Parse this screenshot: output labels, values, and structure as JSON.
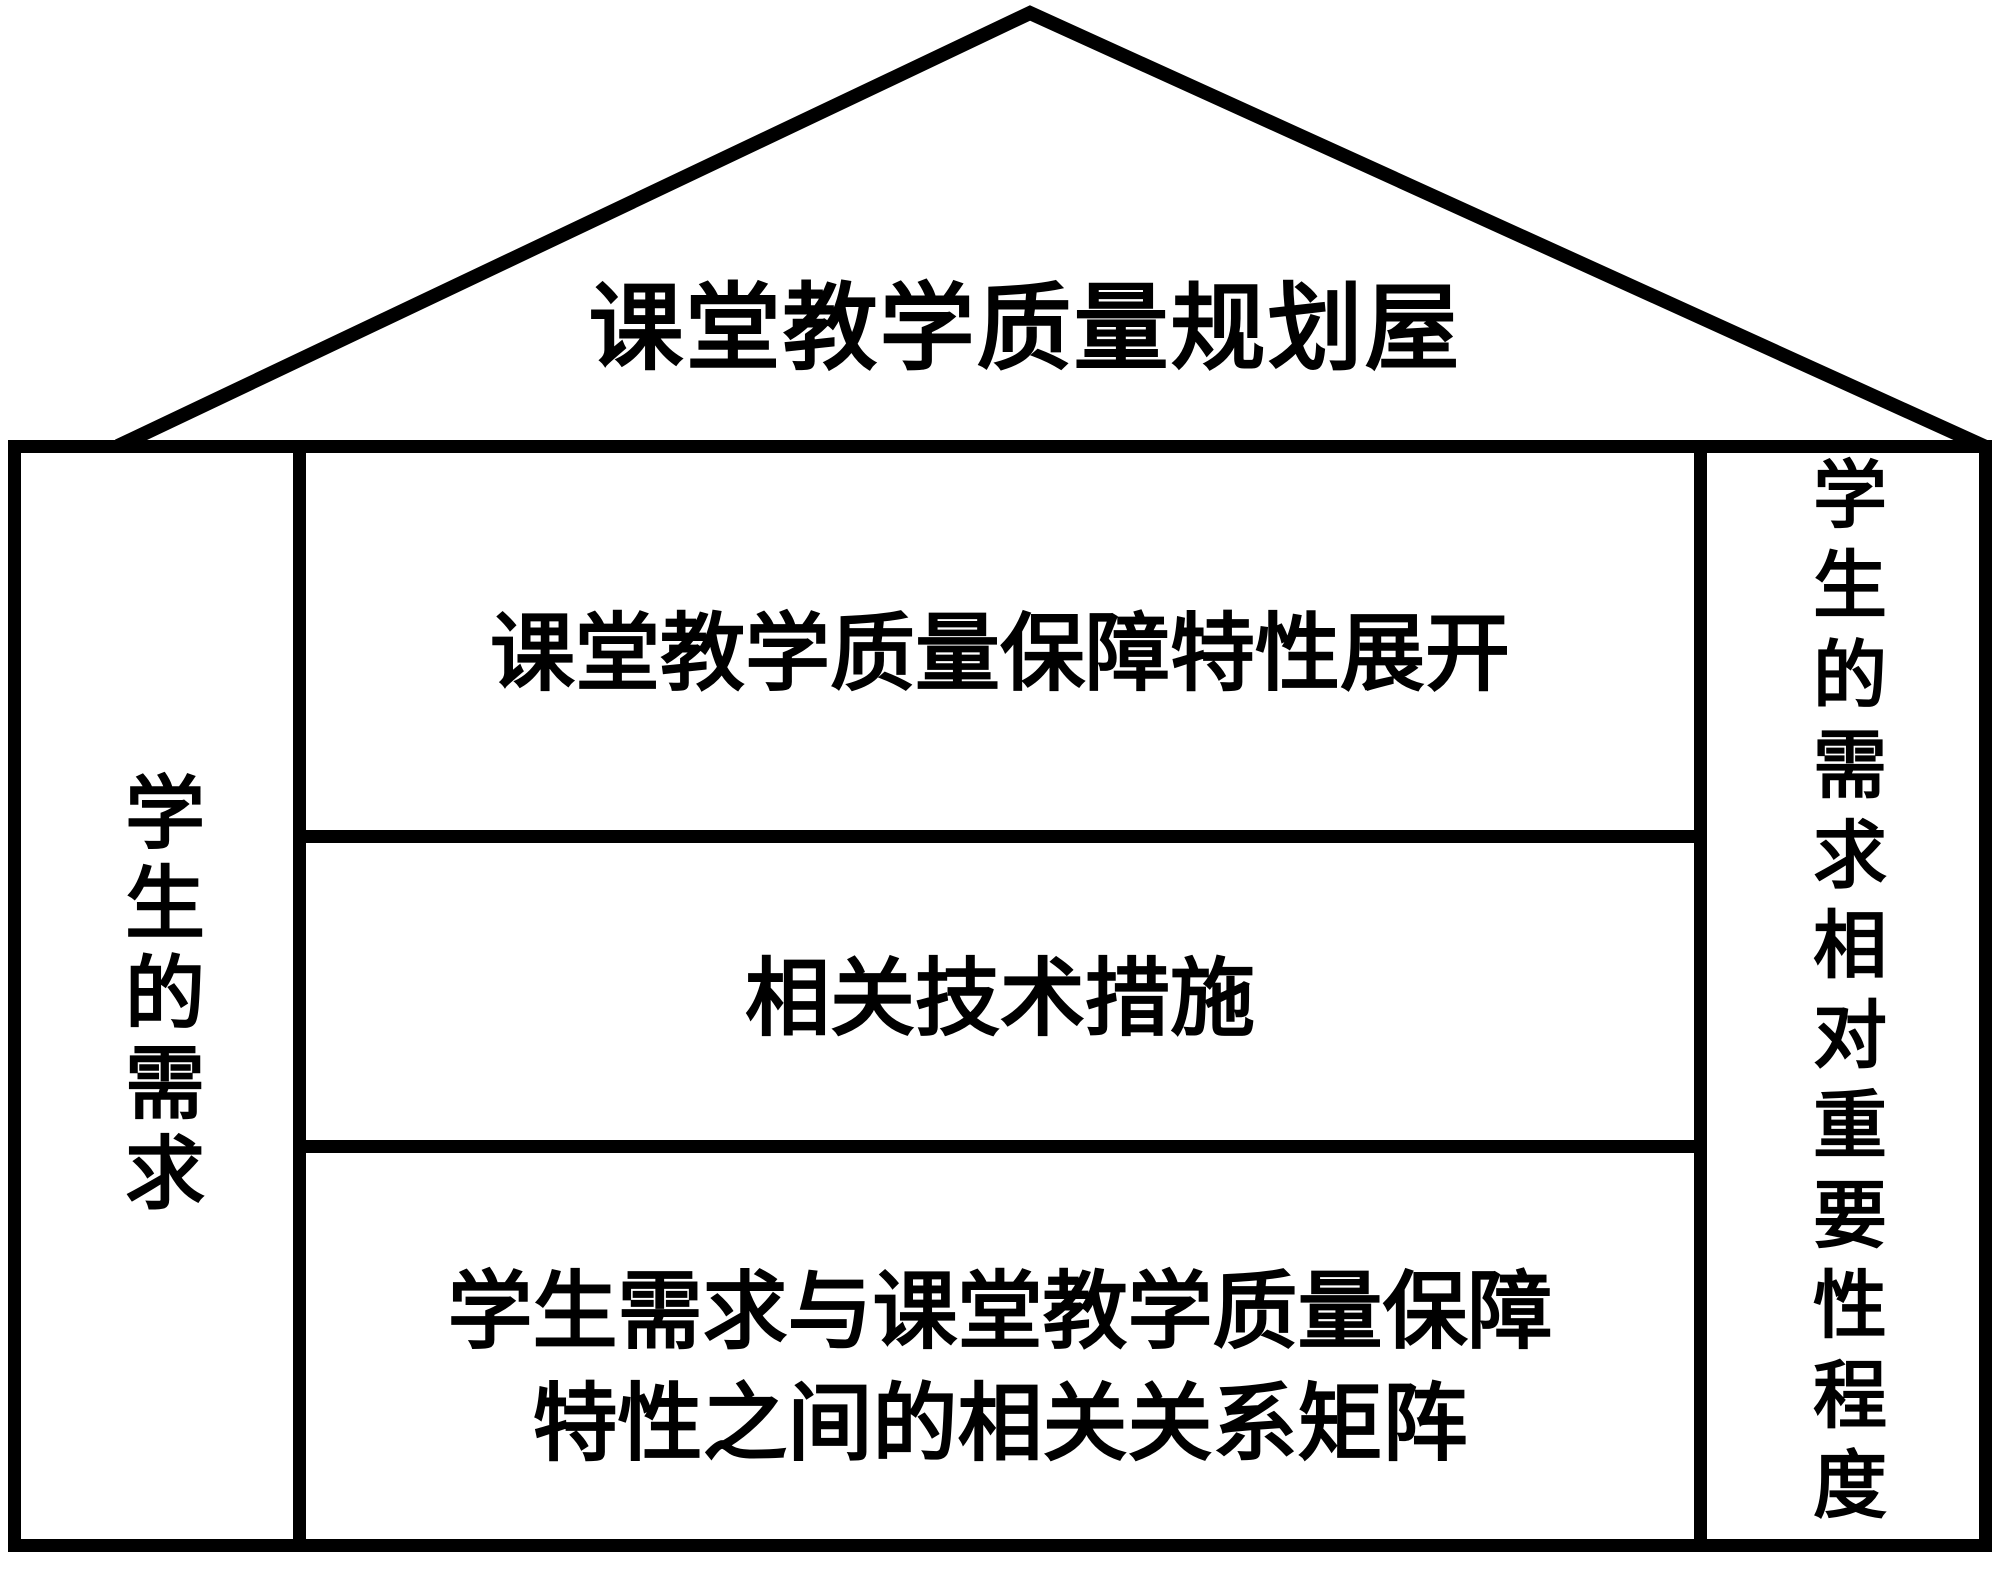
{
  "diagram": {
    "type": "house-of-quality",
    "roof": {
      "title": "课堂教学质量规划屋"
    },
    "left_column": {
      "label": "学生的需求"
    },
    "right_column": {
      "label": "学生的需求相对重要性程度"
    },
    "rows": [
      {
        "label": "课堂教学质量保障特性展开"
      },
      {
        "label": "相关技术措施"
      },
      {
        "label_line1": "学生需求与课堂教学质量保障",
        "label_line2": "特性之间的相关关系矩阵"
      }
    ],
    "colors": {
      "line": "#000000",
      "background": "#ffffff",
      "text": "#000000"
    }
  }
}
